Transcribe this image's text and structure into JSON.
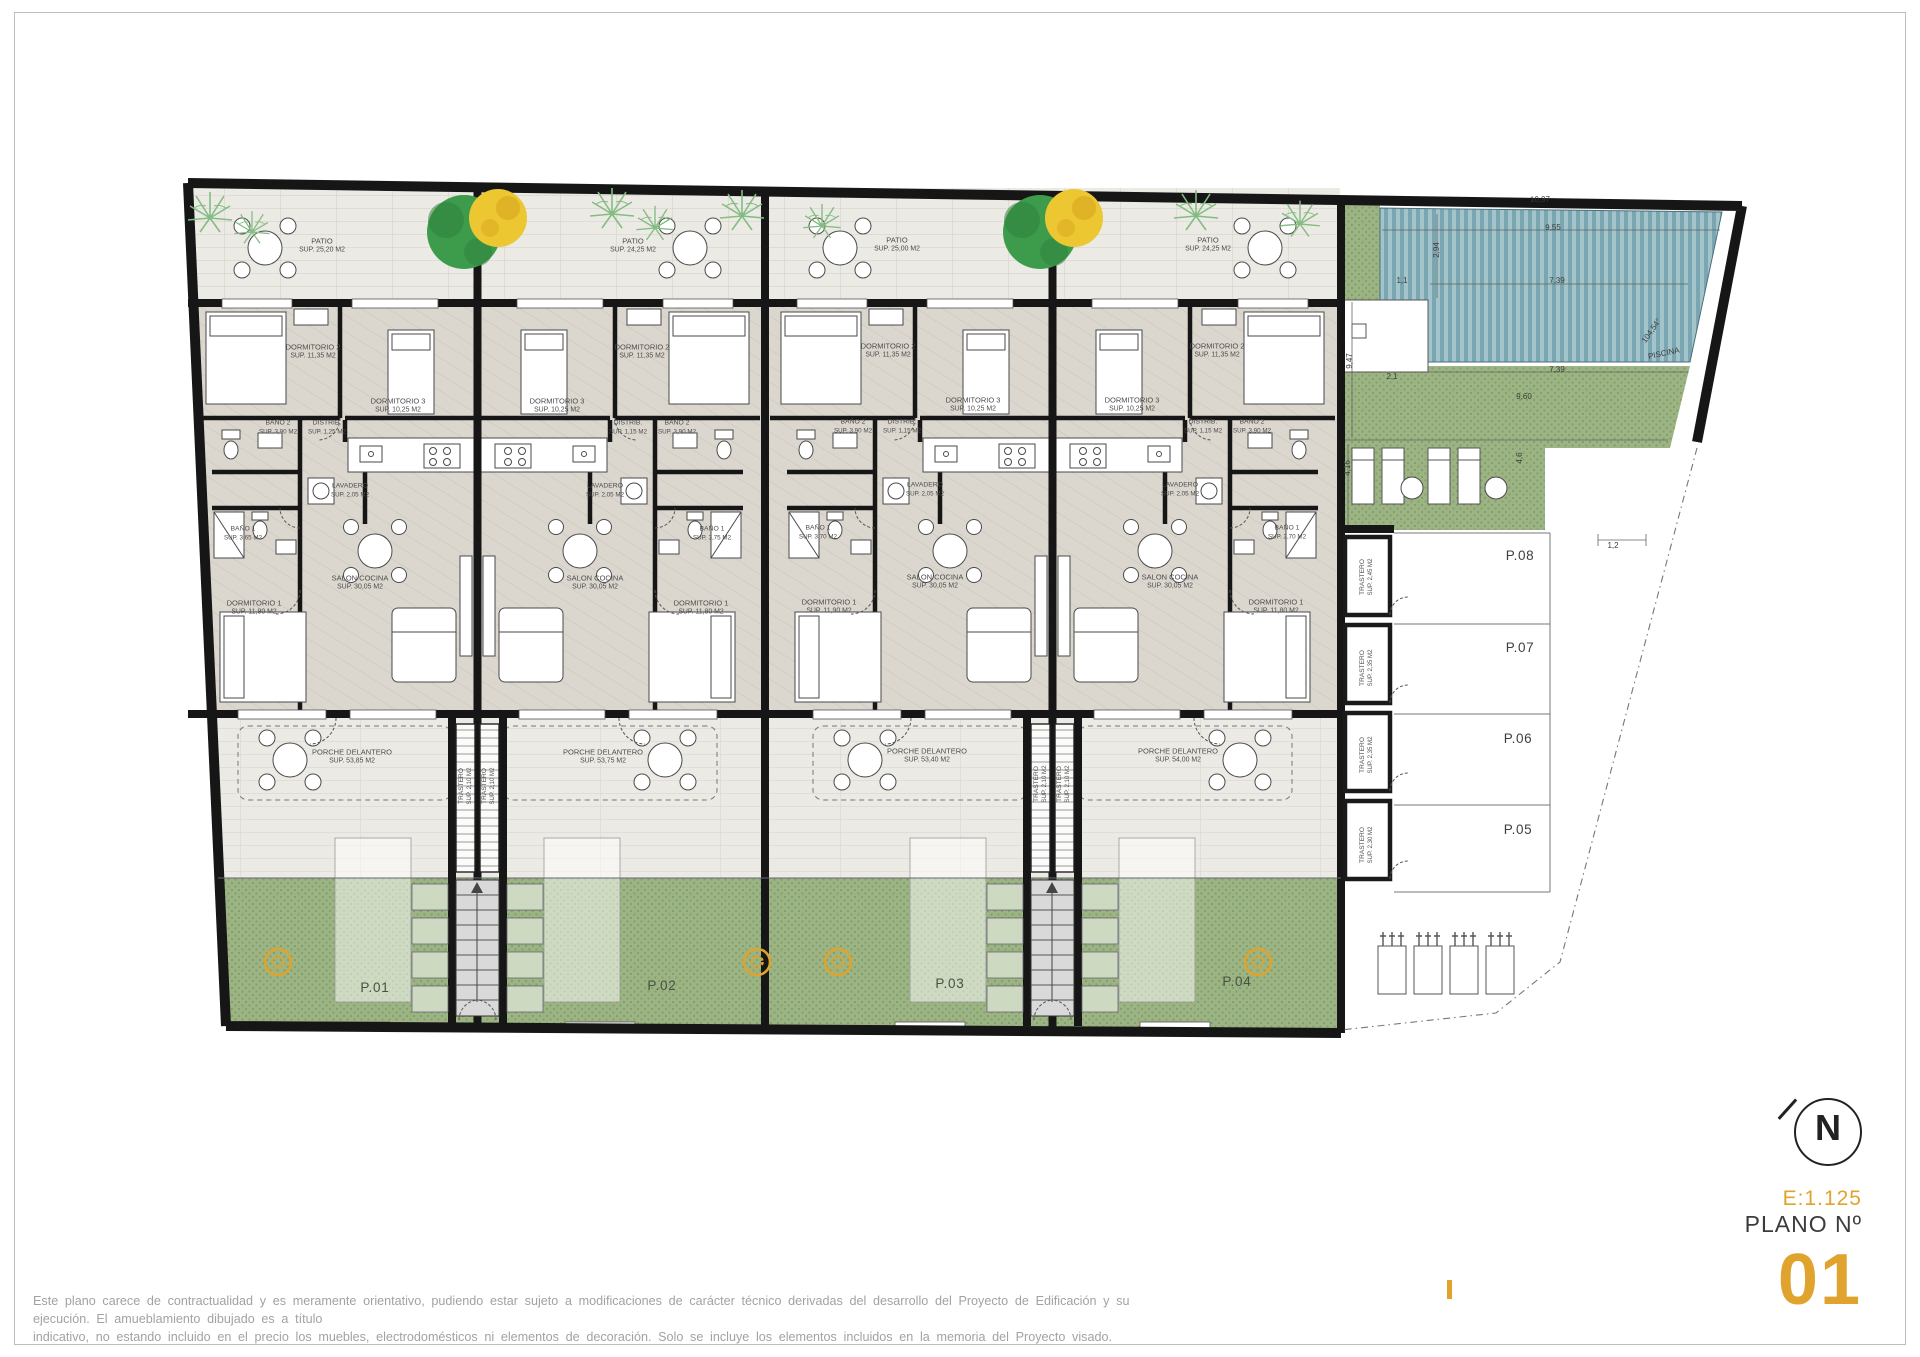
{
  "colors": {
    "accent": "#dfa32e",
    "wall": "#161616",
    "green": "#9cb483",
    "green_dark": "#82a069",
    "pool": "#79a6b0",
    "pool_light": "#a3c4ca",
    "patio_floor": "#eceae5",
    "interior_floor": "#dbd7cf",
    "porch_floor": "#eceae5",
    "label": "#4c4c4c",
    "dim": "#3c3c3c",
    "planter": "#cdd9c0",
    "tree_green": "#3d9c4c",
    "tree_yellow": "#ecc732",
    "palm": "#84bd82",
    "disclaimer": "#a2a2a2",
    "border": "#bdbdbd"
  },
  "title_block": {
    "north_letter": "N",
    "scale_label": "E:1.125",
    "plano_label": "PLANO Nº",
    "plano_number": "01"
  },
  "disclaimer": {
    "line1": "Este plano carece de contractualidad y es meramente orientativo, pudiendo estar sujeto a modificaciones de carácter técnico derivadas del desarrollo del Proyecto de Edificación y su ejecución. El amueblamiento dibujado es a título",
    "line2": "indicativo, no estando incluido en el precio los muebles, electrodomésticos ni elementos de decoración. Solo se incluye los elementos incluidos en la memoria del Proyecto visado."
  },
  "floorplan": {
    "room_labels": [
      {
        "id": "room-label-p01-patio",
        "name": "PATIO",
        "sup": "SUP. 25,20 M2",
        "x": 322,
        "y": 246
      },
      {
        "id": "room-label-p01-dormitorio2",
        "name": "DORMITORIO 2",
        "sup": "SUP. 11,35 M2",
        "x": 313,
        "y": 352
      },
      {
        "id": "room-label-p01-dormitorio3",
        "name": "DORMITORIO 3",
        "sup": "SUP. 10,25 M2",
        "x": 398,
        "y": 406
      },
      {
        "id": "room-label-p01-bano2",
        "name": "BAÑO 2",
        "sup": "SUP. 3,90 M2",
        "x": 278,
        "y": 428,
        "fs": 6.8
      },
      {
        "id": "room-label-p01-distrib",
        "name": "DISTRIB.",
        "sup": "SUP. 1,25 M2",
        "x": 327,
        "y": 428,
        "fs": 6.8
      },
      {
        "id": "room-label-p01-lavadero",
        "name": "LAVADERO",
        "sup": "SUP. 2,05 M2",
        "x": 350,
        "y": 491,
        "fs": 6.8
      },
      {
        "id": "room-label-p01-bano1",
        "name": "BAÑO 1",
        "sup": "SUP. 3,65 M2",
        "x": 243,
        "y": 534,
        "fs": 6.8
      },
      {
        "id": "room-label-p01-salon",
        "name": "SALON COCINA",
        "sup": "SUP. 30,05 M2",
        "x": 360,
        "y": 583
      },
      {
        "id": "room-label-p01-dormitorio1",
        "name": "DORMITORIO 1",
        "sup": "SUP. 11,90 M2",
        "x": 254,
        "y": 608
      },
      {
        "id": "room-label-p01-porche",
        "name": "PORCHE DELANTERO",
        "sup": "SUP. 53,85 M2",
        "x": 352,
        "y": 757
      },
      {
        "id": "room-label-p02-patio",
        "name": "PATIO",
        "sup": "SUP. 24,25 M2",
        "x": 633,
        "y": 246
      },
      {
        "id": "room-label-p02-dormitorio2",
        "name": "DORMITORIO 2",
        "sup": "SUP. 11,35 M2",
        "x": 642,
        "y": 352
      },
      {
        "id": "room-label-p02-dormitorio3",
        "name": "DORMITORIO 3",
        "sup": "SUP. 10,25 M2",
        "x": 557,
        "y": 406
      },
      {
        "id": "room-label-p02-bano2",
        "name": "BAÑO 2",
        "sup": "SUP. 3,90 M2",
        "x": 677,
        "y": 428,
        "fs": 6.8
      },
      {
        "id": "room-label-p02-distrib",
        "name": "DISTRIB.",
        "sup": "SUP. 1,15 M2",
        "x": 628,
        "y": 428,
        "fs": 6.8
      },
      {
        "id": "room-label-p02-lavadero",
        "name": "LAVADERO",
        "sup": "SUP. 2,05 M2",
        "x": 605,
        "y": 491,
        "fs": 6.8
      },
      {
        "id": "room-label-p02-bano1",
        "name": "BAÑO 1",
        "sup": "SUP. 3,75 M2",
        "x": 712,
        "y": 534,
        "fs": 6.8
      },
      {
        "id": "room-label-p02-salon",
        "name": "SALON COCINA",
        "sup": "SUP. 30,05 M2",
        "x": 595,
        "y": 583
      },
      {
        "id": "room-label-p02-dormitorio1",
        "name": "DORMITORIO 1",
        "sup": "SUP. 11,80 M2",
        "x": 701,
        "y": 608
      },
      {
        "id": "room-label-p02-porche",
        "name": "PORCHE DELANTERO",
        "sup": "SUP. 53,75 M2",
        "x": 603,
        "y": 757
      },
      {
        "id": "room-label-p03-patio",
        "name": "PATIO",
        "sup": "SUP. 25,00 M2",
        "x": 897,
        "y": 245
      },
      {
        "id": "room-label-p03-dormitorio2",
        "name": "DORMITORIO 2",
        "sup": "SUP. 11,35 M2",
        "x": 888,
        "y": 351
      },
      {
        "id": "room-label-p03-dormitorio3",
        "name": "DORMITORIO 3",
        "sup": "SUP. 10,25 M2",
        "x": 973,
        "y": 405
      },
      {
        "id": "room-label-p03-bano2",
        "name": "BAÑO 2",
        "sup": "SUP. 3,90 M2",
        "x": 853,
        "y": 427,
        "fs": 6.8
      },
      {
        "id": "room-label-p03-distrib",
        "name": "DISTRIB.",
        "sup": "SUP. 1,15 M2",
        "x": 902,
        "y": 427,
        "fs": 6.8
      },
      {
        "id": "room-label-p03-lavadero",
        "name": "LAVADERO",
        "sup": "SUP. 2,05 M2",
        "x": 925,
        "y": 490,
        "fs": 6.8
      },
      {
        "id": "room-label-p03-bano1",
        "name": "BAÑO 1",
        "sup": "SUP. 3,70 M2",
        "x": 818,
        "y": 533,
        "fs": 6.8
      },
      {
        "id": "room-label-p03-salon",
        "name": "SALON COCINA",
        "sup": "SUP. 30,05 M2",
        "x": 935,
        "y": 582
      },
      {
        "id": "room-label-p03-dormitorio1",
        "name": "DORMITORIO 1",
        "sup": "SUP. 11,90 M2",
        "x": 829,
        "y": 607
      },
      {
        "id": "room-label-p03-porche",
        "name": "PORCHE DELANTERO",
        "sup": "SUP. 53,40 M2",
        "x": 927,
        "y": 756
      },
      {
        "id": "room-label-p04-patio",
        "name": "PATIO",
        "sup": "SUP. 24,25 M2",
        "x": 1208,
        "y": 245
      },
      {
        "id": "room-label-p04-dormitorio2",
        "name": "DORMITORIO 2",
        "sup": "SUP. 11,35 M2",
        "x": 1217,
        "y": 351
      },
      {
        "id": "room-label-p04-dormitorio3",
        "name": "DORMITORIO 3",
        "sup": "SUP. 10,25 M2",
        "x": 1132,
        "y": 405
      },
      {
        "id": "room-label-p04-bano2",
        "name": "BAÑO 2",
        "sup": "SUP. 3,90 M2",
        "x": 1252,
        "y": 427,
        "fs": 6.8
      },
      {
        "id": "room-label-p04-distrib",
        "name": "DISTRIB.",
        "sup": "SUP. 1,15 M2",
        "x": 1203,
        "y": 427,
        "fs": 6.8
      },
      {
        "id": "room-label-p04-lavadero",
        "name": "LAVADERO",
        "sup": "SUP. 2,05 M2",
        "x": 1180,
        "y": 490,
        "fs": 6.8
      },
      {
        "id": "room-label-p04-bano1",
        "name": "BAÑO 1",
        "sup": "SUP. 3,70 M2",
        "x": 1287,
        "y": 533,
        "fs": 6.8
      },
      {
        "id": "room-label-p04-salon",
        "name": "SALON COCINA",
        "sup": "SUP. 30,05 M2",
        "x": 1170,
        "y": 582
      },
      {
        "id": "room-label-p04-dormitorio1",
        "name": "DORMITORIO 1",
        "sup": "SUP. 11,80 M2",
        "x": 1276,
        "y": 607
      },
      {
        "id": "room-label-p04-porche",
        "name": "PORCHE DELANTERO",
        "sup": "SUP. 54,00 M2",
        "x": 1178,
        "y": 756
      },
      {
        "id": "trastero-core1-left",
        "name": "TRASTERO",
        "sup": "SUP. 2,10 M2",
        "x": 466,
        "y": 786,
        "rot": -90,
        "fs": 6.6
      },
      {
        "id": "trastero-core1-right",
        "name": "TRASTERO",
        "sup": "SUP. 2,10 M2",
        "x": 489,
        "y": 786,
        "rot": -90,
        "fs": 6.6
      },
      {
        "id": "trastero-core2-left",
        "name": "TRASTERO",
        "sup": "SUP. 2,10 M2",
        "x": 1041,
        "y": 784,
        "rot": -90,
        "fs": 6.6
      },
      {
        "id": "trastero-core2-right",
        "name": "TRASTERO",
        "sup": "SUP. 2,10 M2",
        "x": 1064,
        "y": 784,
        "rot": -90,
        "fs": 6.6
      },
      {
        "id": "trastero-p08",
        "name": "TRASTERO",
        "sup": "SUP. 2,45 M2",
        "x": 1367,
        "y": 577,
        "rot": -90,
        "fs": 6.6
      },
      {
        "id": "trastero-p07",
        "name": "TRASTERO",
        "sup": "SUP. 2,35 M2",
        "x": 1367,
        "y": 668,
        "rot": -90,
        "fs": 6.6
      },
      {
        "id": "trastero-p06",
        "name": "TRASTERO",
        "sup": "SUP. 2,35 M2",
        "x": 1367,
        "y": 755,
        "rot": -90,
        "fs": 6.6
      },
      {
        "id": "trastero-p05",
        "name": "TRASTERO",
        "sup": "SUP. 2,30 M2",
        "x": 1367,
        "y": 845,
        "rot": -90,
        "fs": 6.6
      }
    ],
    "unit_labels": [
      {
        "id": "unit-label-p01",
        "text": "P.01",
        "x": 375,
        "y": 988
      },
      {
        "id": "unit-label-p02",
        "text": "P.02",
        "x": 662,
        "y": 986
      },
      {
        "id": "unit-label-p03",
        "text": "P.03",
        "x": 950,
        "y": 984
      },
      {
        "id": "unit-label-p04",
        "text": "P.04",
        "x": 1237,
        "y": 982
      }
    ],
    "parking_labels": [
      {
        "id": "parking-label-p08",
        "text": "P.08",
        "x": 1520,
        "y": 556
      },
      {
        "id": "parking-label-p07",
        "text": "P.07",
        "x": 1520,
        "y": 648
      },
      {
        "id": "parking-label-p06",
        "text": "P.06",
        "x": 1518,
        "y": 739
      },
      {
        "id": "parking-label-p05",
        "text": "P.05",
        "x": 1518,
        "y": 830
      }
    ],
    "dim_labels": [
      {
        "id": "dim-10-97",
        "text": "10,97",
        "x": 1540,
        "y": 200,
        "rot": -1
      },
      {
        "id": "dim-9-55",
        "text": "9,55",
        "x": 1553,
        "y": 228,
        "rot": -1
      },
      {
        "id": "dim-7-39-a",
        "text": "7,39",
        "x": 1557,
        "y": 281,
        "rot": -1
      },
      {
        "id": "dim-7-39-b",
        "text": "7,39",
        "x": 1557,
        "y": 370,
        "rot": -1
      },
      {
        "id": "dim-9-60",
        "text": "9,60",
        "x": 1524,
        "y": 397
      },
      {
        "id": "dim-2-94",
        "text": "2,94",
        "x": 1437,
        "y": 250,
        "rot": -90
      },
      {
        "id": "dim-1-1",
        "text": "1,1",
        "x": 1402,
        "y": 281
      },
      {
        "id": "dim-9-47",
        "text": "9,47",
        "x": 1350,
        "y": 361,
        "rot": -90
      },
      {
        "id": "dim-2-1",
        "text": "2,1",
        "x": 1392,
        "y": 377
      },
      {
        "id": "dim-4-16",
        "text": "4,16",
        "x": 1348,
        "y": 468,
        "rot": -90
      },
      {
        "id": "dim-4-6",
        "text": "4,6",
        "x": 1520,
        "y": 458,
        "rot": -90
      },
      {
        "id": "dim-angle",
        "text": "104,54°",
        "x": 1652,
        "y": 331,
        "rot": -55
      },
      {
        "id": "piscina-label",
        "text": "PISCINA",
        "x": 1664,
        "y": 354,
        "rot": -12
      },
      {
        "id": "dim-1-2",
        "text": "1,2",
        "x": 1613,
        "y": 546
      }
    ]
  }
}
